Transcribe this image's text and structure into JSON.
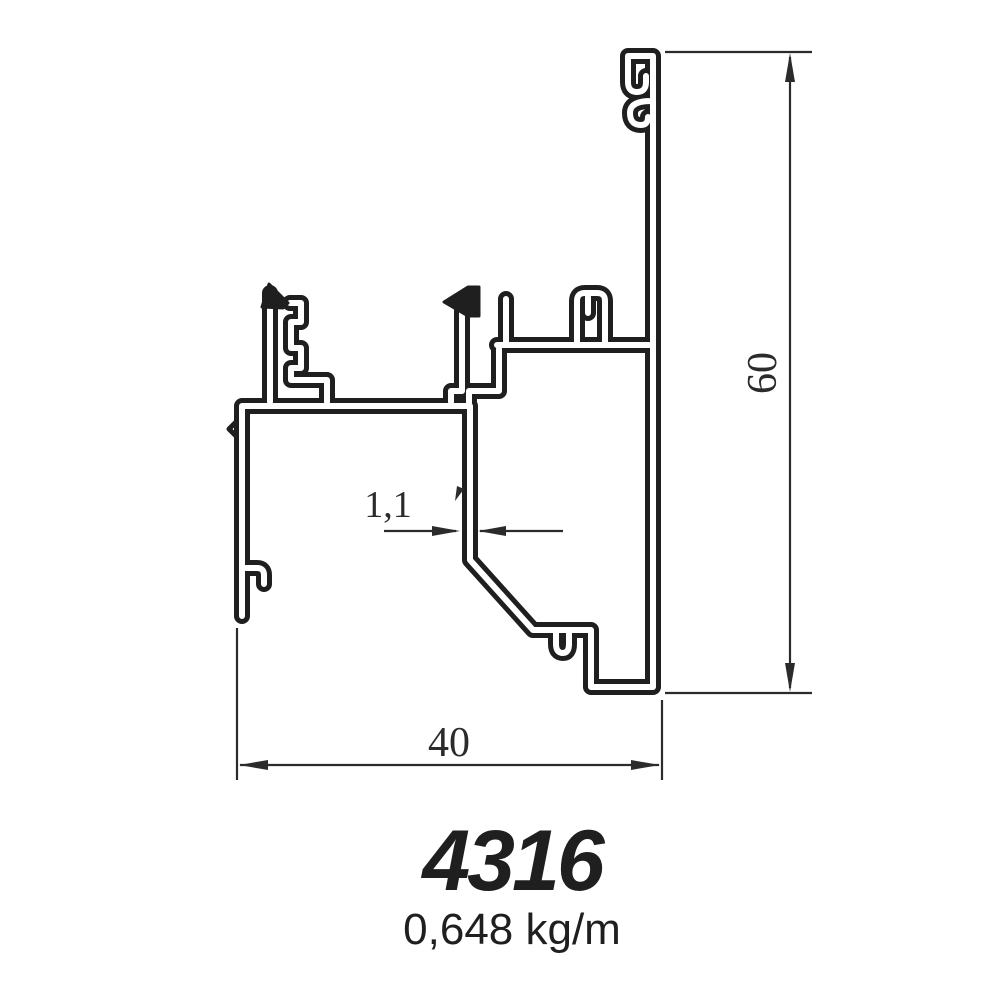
{
  "drawing": {
    "profile_code": "4316",
    "weight_per_meter": "0,648 kg/m",
    "dimensions": {
      "overall_width": "40",
      "overall_height": "60",
      "wall_thickness": "1,1"
    }
  },
  "colors": {
    "line": "#1f1f1f",
    "dimension": "#2b2b2b",
    "background": "#ffffff"
  }
}
